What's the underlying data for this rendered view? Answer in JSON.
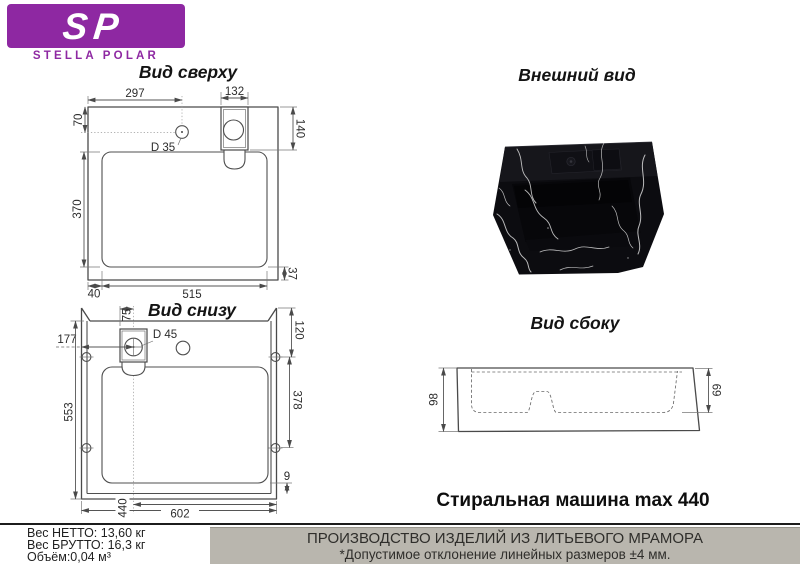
{
  "logo": {
    "sp": "SP",
    "name": "STELLA POLAR",
    "purple": "#8e28a2"
  },
  "top_view": {
    "title": "Вид сверху",
    "dims": {
      "w297": "297",
      "w132": "132",
      "h70": "70",
      "h140": "140",
      "hole": "D 35",
      "h370": "370",
      "h37": "37",
      "w40": "40",
      "w515": "515"
    }
  },
  "external_view": {
    "title": "Внешний вид"
  },
  "bottom_view": {
    "title": "Вид снизу",
    "dims": {
      "w75": "75",
      "w177": "177",
      "hole": "D 45",
      "h120": "120",
      "h378": "378",
      "h553": "553",
      "h9": "9",
      "w440": "440",
      "w602": "602"
    }
  },
  "side_view": {
    "title": "Вид сбоку",
    "dims": {
      "h98": "98",
      "h69": "69"
    }
  },
  "caption": {
    "washing_machine": "Стиральная машина max 440"
  },
  "footer": {
    "weight_net": "Вес НЕТТО: 13,60 кг",
    "weight_gross": "Вес БРУТТО: 16,3 кг",
    "volume": "Объём:0,04 м³",
    "production_line1": "ПРОИЗВОДСТВО ИЗДЕЛИЙ ИЗ ЛИТЬЕВОГО МРАМОРА",
    "production_line2": "*Допустимое отклонение линейных размеров ±4 мм.",
    "box_bg": "#b9b6ae"
  }
}
